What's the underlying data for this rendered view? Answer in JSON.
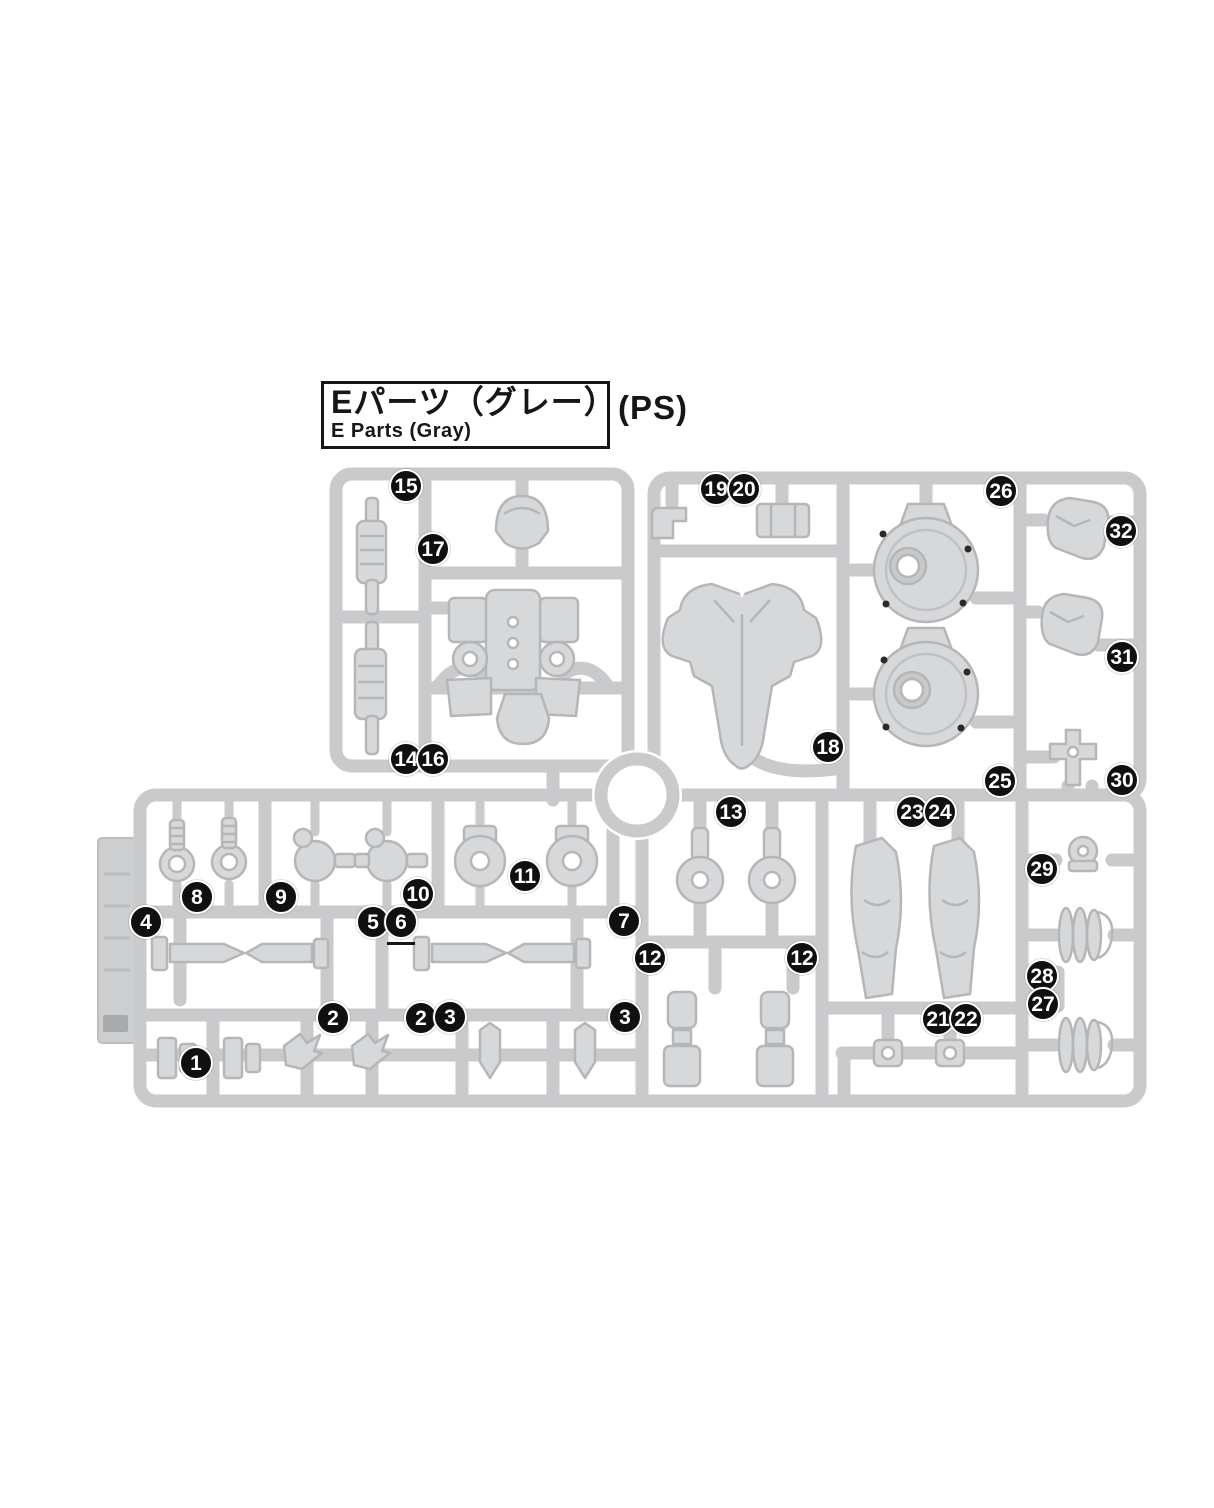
{
  "title": {
    "jp": "Eパーツ（グレー）",
    "en": "E Parts (Gray)",
    "material": "(PS)"
  },
  "colors": {
    "runner_gray": "#c9cacc",
    "part_fill": "#d7d8da",
    "part_line": "#b5b6b8",
    "tab_fill": "#cdced0",
    "callout_bg": "#101010",
    "callout_text": "#ffffff",
    "title_text": "#161616"
  },
  "callouts": [
    {
      "n": "15",
      "x": 406,
      "y": 486
    },
    {
      "n": "17",
      "x": 433,
      "y": 549
    },
    {
      "n": "19",
      "x": 716,
      "y": 489
    },
    {
      "n": "20",
      "x": 744,
      "y": 489
    },
    {
      "n": "26",
      "x": 1001,
      "y": 491
    },
    {
      "n": "32",
      "x": 1121,
      "y": 531
    },
    {
      "n": "31",
      "x": 1122,
      "y": 657
    },
    {
      "n": "14",
      "x": 406,
      "y": 759
    },
    {
      "n": "16",
      "x": 433,
      "y": 759
    },
    {
      "n": "18",
      "x": 828,
      "y": 747
    },
    {
      "n": "25",
      "x": 1000,
      "y": 781
    },
    {
      "n": "30",
      "x": 1122,
      "y": 780
    },
    {
      "n": "13",
      "x": 731,
      "y": 812
    },
    {
      "n": "23",
      "x": 912,
      "y": 812
    },
    {
      "n": "24",
      "x": 940,
      "y": 812
    },
    {
      "n": "11",
      "x": 525,
      "y": 876
    },
    {
      "n": "29",
      "x": 1042,
      "y": 869
    },
    {
      "n": "8",
      "x": 197,
      "y": 897
    },
    {
      "n": "9",
      "x": 281,
      "y": 897
    },
    {
      "n": "10",
      "x": 418,
      "y": 894
    },
    {
      "n": "4",
      "x": 146,
      "y": 922
    },
    {
      "n": "5",
      "x": 373,
      "y": 922
    },
    {
      "n": "6",
      "x": 401,
      "y": 922,
      "underline": true
    },
    {
      "n": "7",
      "x": 624,
      "y": 921
    },
    {
      "n": "12",
      "x": 650,
      "y": 958
    },
    {
      "n": "12",
      "x": 802,
      "y": 958
    },
    {
      "n": "28",
      "x": 1042,
      "y": 976
    },
    {
      "n": "27",
      "x": 1043,
      "y": 1004
    },
    {
      "n": "2",
      "x": 333,
      "y": 1018
    },
    {
      "n": "2",
      "x": 421,
      "y": 1018
    },
    {
      "n": "3",
      "x": 450,
      "y": 1017
    },
    {
      "n": "3",
      "x": 625,
      "y": 1017
    },
    {
      "n": "21",
      "x": 938,
      "y": 1019
    },
    {
      "n": "22",
      "x": 966,
      "y": 1019
    },
    {
      "n": "1",
      "x": 196,
      "y": 1063
    }
  ]
}
